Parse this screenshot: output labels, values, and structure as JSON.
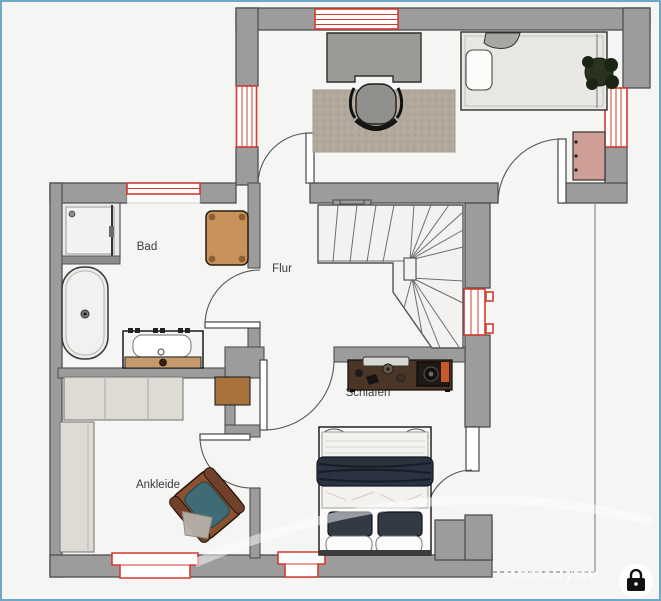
{
  "floorplan": {
    "rooms": [
      {
        "id": "bad",
        "label": "Bad"
      },
      {
        "id": "flur",
        "label": "Flur"
      },
      {
        "id": "ankleide",
        "label": "Ankleide"
      },
      {
        "id": "schlafen",
        "label": "Schlafen"
      }
    ],
    "watermark": {
      "text": "HomeByMe",
      "lock_icon": "padlock"
    },
    "colors": {
      "background": "#f5f5f3",
      "border_blue": "#6fa8c6",
      "wall": "#9c9c9c",
      "wall_outline": "#4f4f4f",
      "window_red": "#d23b2f",
      "stair": "#f3f2f0",
      "label": "#3a3a3a",
      "wood_light": "#c8935a",
      "wood_mid": "#a9713b",
      "wood_dark": "#4a3527",
      "dresser_pink": "#cf9e97",
      "rug": "#b2a89b",
      "bed_navy": "#2b3340",
      "armchair_leather": "#8a5231",
      "armchair_teal": "#3e6b74",
      "cabinet_gray": "#dedbd5"
    }
  }
}
